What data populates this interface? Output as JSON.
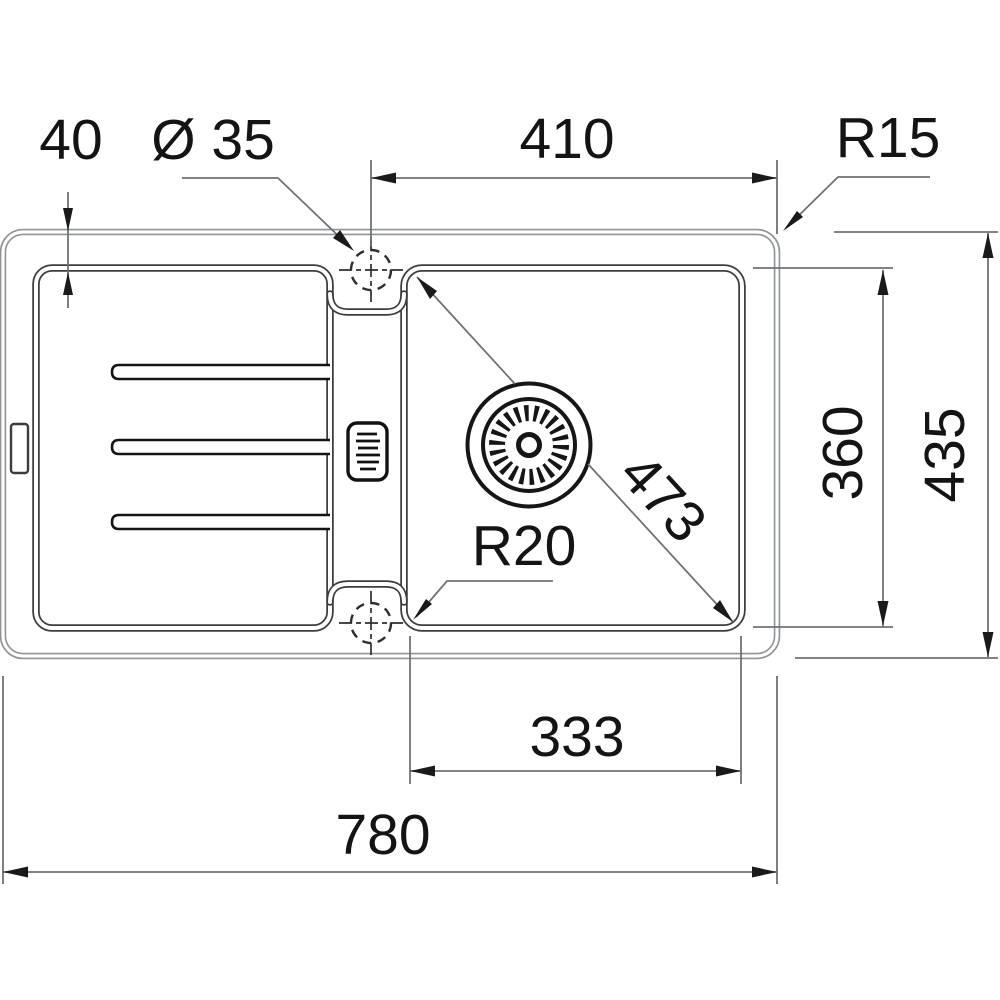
{
  "drawing": {
    "kind": "technical-drawing",
    "subject": "Inset kitchen sink with drainboard and single bowl, top view",
    "colors": {
      "outline": "#3d3d3d",
      "rim_line": "#8f9498",
      "dimension_line": "#6e7276",
      "text": "#141414",
      "background": "#ffffff"
    },
    "dimensions": {
      "deck_margin": "40",
      "tap_hole_diameter": "Ø 35",
      "tap_hole_to_right_edge": "410",
      "outer_corner_radius": "R15",
      "bowl_depth": "360",
      "overall_depth": "435",
      "bowl_diagonal": "473",
      "bowl_corner_radius": "R20",
      "bowl_width": "333",
      "overall_length": "780"
    }
  }
}
